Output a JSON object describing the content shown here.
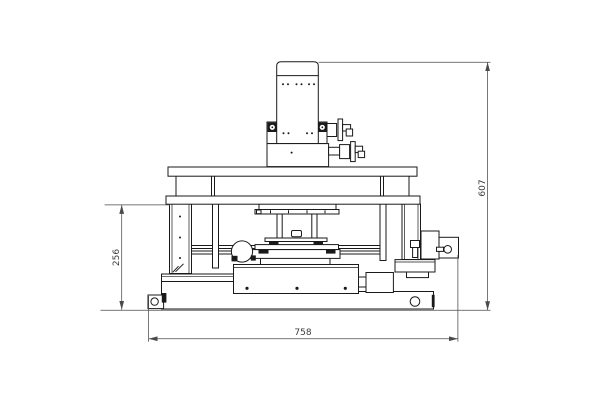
{
  "drawing": {
    "background": "#ffffff",
    "line_color": "#1a1a1a",
    "dimension_color": "#4a4a4a",
    "dimensions": {
      "overall_height": "607",
      "stage_height": "256",
      "overall_width": "758"
    }
  }
}
